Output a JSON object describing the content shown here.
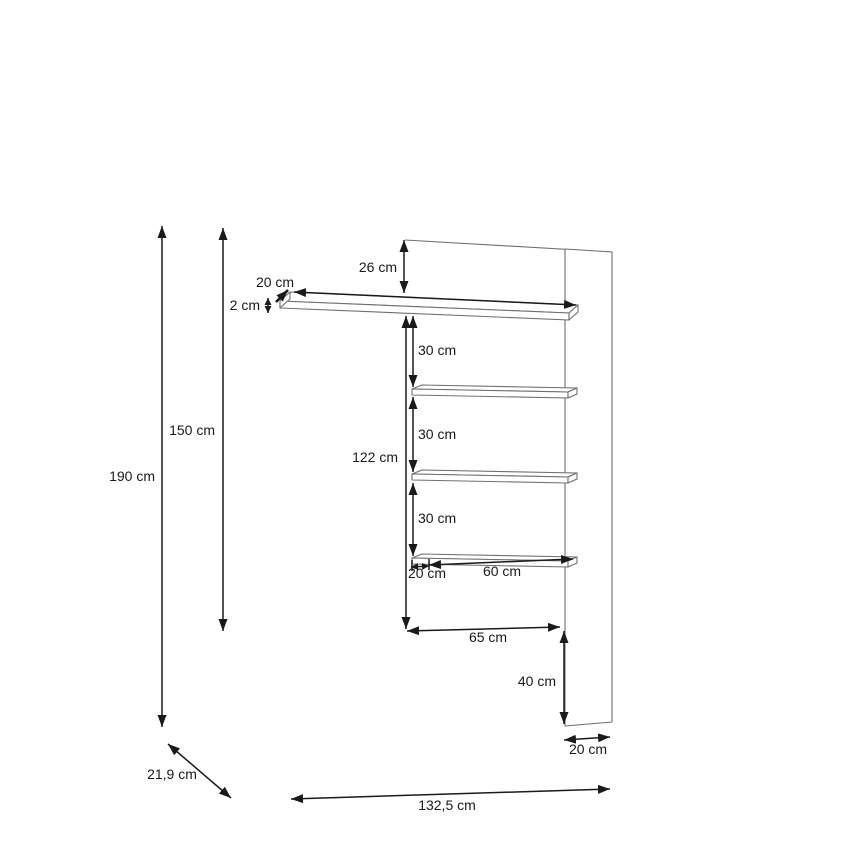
{
  "drawing": {
    "kind": "furniture-dimension-diagram",
    "subject": "wall panel with four shelves",
    "unit_system": "cm",
    "colors": {
      "background": "#ffffff",
      "dimension_lines": "#1a1a1a",
      "furniture_lines": "#6f6f6f",
      "text": "#1a1a1a"
    },
    "labels": {
      "total_height": "190 cm",
      "left_height": "150 cm",
      "top_gap": "26 cm",
      "top_shelf_depth": "20 cm",
      "top_shelf_thickness": "2 cm",
      "gap_shelf_1": "30 cm",
      "inner_height": "122 cm",
      "gap_shelf_2": "30 cm",
      "gap_shelf_3": "30 cm",
      "bottom_shelf_offset": "20 cm",
      "bottom_shelf_length": "60 cm",
      "inner_width": "65 cm",
      "panel_bottom_height": "40 cm",
      "panel_width": "20 cm",
      "depth": "21,9 cm",
      "total_width": "132,5 cm"
    }
  }
}
